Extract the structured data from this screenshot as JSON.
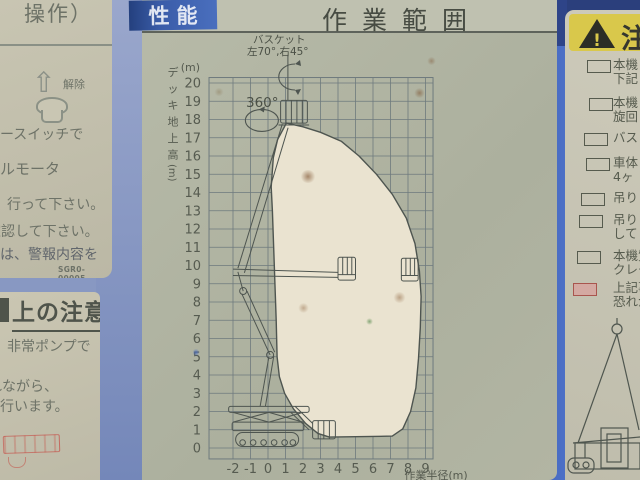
{
  "placards": {
    "left_top": {
      "heading_fragment": "操作）",
      "release_label": "解除",
      "line_switch": "ースイッチで",
      "line_motor": "ルモータ",
      "line_do": "行って下さい。",
      "line_confirm": "確認して下さい。",
      "line_alarm": "は、警報内容を",
      "doc_code": "SGR0-00005"
    },
    "left_bottom": {
      "heading": "上の注意",
      "line_pump": "非常ポンプで",
      "line_nagara": "れながら、",
      "line_okonau": "行います。"
    },
    "right": {
      "header": "注",
      "warning_mark": "!",
      "checklist": [
        {
          "lines": [
            "本機",
            "下記"
          ],
          "highlight": false
        },
        {
          "lines": [
            "本機",
            "旋回"
          ],
          "highlight": false
        },
        {
          "lines": [
            "バス"
          ],
          "highlight": false
        },
        {
          "lines": [
            "車体",
            "4ヶ"
          ],
          "highlight": false
        },
        {
          "lines": [
            "吊り"
          ],
          "highlight": false
        },
        {
          "lines": [
            "吊り",
            "して"
          ],
          "highlight": false
        },
        {
          "lines": [
            "本機質",
            "クレー"
          ],
          "highlight": false
        },
        {
          "lines": [
            "上記事",
            "恐れが"
          ],
          "highlight": true
        }
      ]
    }
  },
  "chart_data": {
    "type": "area",
    "title": "作業範囲",
    "tag": "性能",
    "xlabel": "作業半径(m)",
    "ylabel_chars": [
      "デ",
      "ッ",
      "キ",
      "地",
      "上",
      "高"
    ],
    "ylabel_unit": "(m)",
    "y_unit_top": "(m)",
    "x_ticks": [
      -2,
      -1,
      0,
      1,
      2,
      3,
      4,
      5,
      6,
      7,
      8,
      9
    ],
    "y_ticks": [
      0,
      1,
      2,
      3,
      4,
      5,
      6,
      7,
      8,
      9,
      10,
      11,
      12,
      13,
      14,
      15,
      16,
      17,
      18,
      19,
      20
    ],
    "xlim": [
      -3.37,
      9.43
    ],
    "ylim": [
      -0.6,
      20.3
    ],
    "grid": true,
    "annotations": {
      "basket_line1": "バスケット",
      "basket_line2": "左70°,右45°",
      "rotation": "360°"
    },
    "envelope": [
      [
        1.05,
        17.8
      ],
      [
        2.0,
        17.6
      ],
      [
        3.0,
        17.3
      ],
      [
        4.2,
        16.8
      ],
      [
        5.2,
        16.0
      ],
      [
        6.2,
        15.0
      ],
      [
        7.1,
        13.9
      ],
      [
        7.9,
        12.6
      ],
      [
        8.4,
        11.2
      ],
      [
        8.65,
        9.7
      ],
      [
        8.75,
        8.3
      ],
      [
        8.7,
        6.6
      ],
      [
        8.6,
        4.9
      ],
      [
        8.45,
        3.3
      ],
      [
        8.15,
        2.0
      ],
      [
        7.7,
        1.05
      ],
      [
        7.1,
        0.65
      ],
      [
        3.5,
        0.6
      ],
      [
        2.85,
        0.8
      ],
      [
        2.15,
        1.35
      ],
      [
        1.45,
        2.15
      ],
      [
        0.95,
        3.0
      ],
      [
        0.65,
        3.9
      ],
      [
        0.52,
        5.0
      ],
      [
        0.47,
        7.0
      ],
      [
        0.36,
        10.0
      ],
      [
        0.25,
        13.0
      ],
      [
        0.18,
        14.3
      ],
      [
        0.3,
        15.9
      ],
      [
        0.55,
        16.9
      ],
      [
        1.05,
        17.8
      ]
    ],
    "colors": {
      "envelope_fill": "#eae3d0",
      "grid_line": "#6e7a7e",
      "placard_bg": "#b2b5a3",
      "blue_body": "#4a6cc3",
      "tag_blue": "#3a5ca8",
      "warn_yellow": "#d9c84b",
      "highlight_pink": "#d4a9a2"
    }
  }
}
